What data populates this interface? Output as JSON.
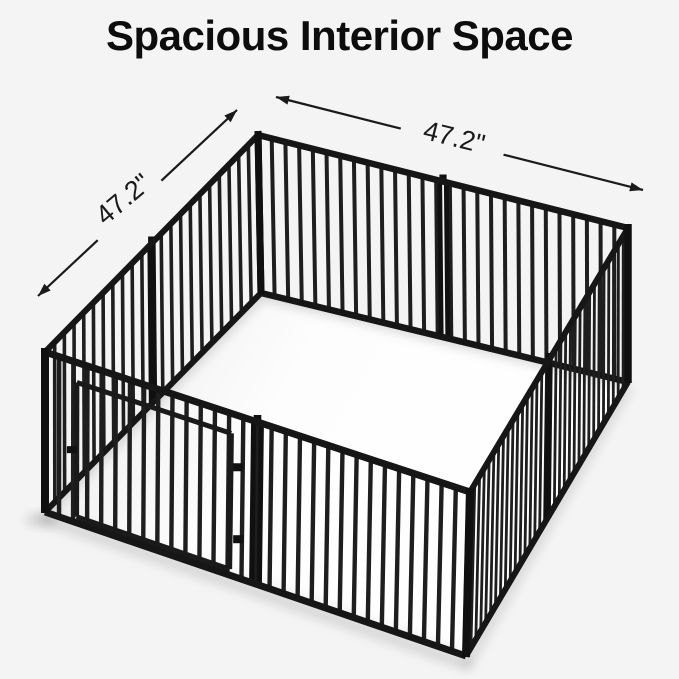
{
  "title": "Spacious Interior Space",
  "dimensions": {
    "width_label": "47.2\"",
    "depth_label": "47.2\""
  },
  "illustration": {
    "alt": "Black metal eight-panel dog playpen with a front gate shown in perspective with an open top and spacious white interior floor"
  },
  "colors": {
    "background": "#f4f4f4",
    "floor": "#ffffff",
    "bar": "#1e1e1e",
    "rail": "#161616",
    "post": "#101010",
    "door": "#1a1a1a",
    "dimension_line": "#1a1a1a",
    "title_text": "#0d0d0d",
    "shadow": "rgba(0,0,0,0.12)"
  }
}
